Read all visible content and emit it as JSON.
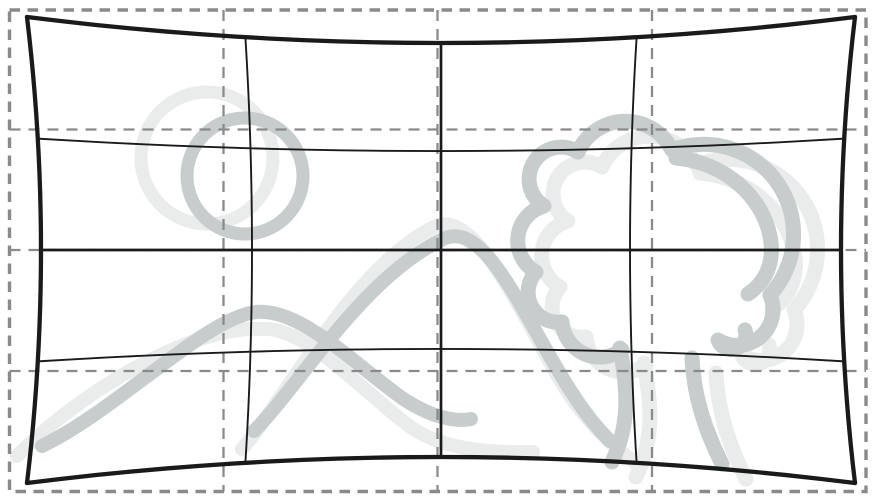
{
  "figure": {
    "width": 877,
    "height": 502,
    "style": "pincushion-distortion",
    "colors": {
      "background": "#ffffff",
      "grid_solid": "#1a1a1a",
      "grid_dashed": "#8a8a8a",
      "sketch_dark": "#c7cccc",
      "sketch_light": "#e9eceb"
    },
    "sketch": {
      "layers": [
        {
          "name": "sun-sketch-light",
          "tone": "sketch_light",
          "stroke_width": 13,
          "shapes": [
            {
              "kind": "circle",
              "cx": 207,
              "cy": 158,
              "r": 66
            }
          ]
        },
        {
          "name": "mountain-sketch-light",
          "tone": "sketch_light",
          "stroke_width": 14,
          "shapes": [
            {
              "kind": "path",
              "d": "M 17,456 C 80,392 192,325 262,329 C 306,326 360,390 412,428 C 444,450 492,453 533,452"
            },
            {
              "kind": "path",
              "d": "M 242,449 C 288,396 352,268 434,227 C 477,206 522,318 566,390 C 590,427 620,452 641,467"
            }
          ]
        },
        {
          "name": "tree-sketch-light",
          "tone": "sketch_light",
          "stroke_width": 15,
          "transform": "translate(24,15)",
          "shapes": [
            {
              "kind": "path",
              "d": "M 622,350 A 38,38 0 0 1 562,322 A 30,30 0 0 1 536,272 A 36,36 0 0 1 544,206 A 30,30 0 0 1 578,152 A 52,52 0 0 1 672,150 A 90,90 0 0 1 770,295 A 36,36 0 0 1 718,340 A 14,14 0 0 0 745,330"
            },
            {
              "kind": "path",
              "d": "M 676,158 C 724,162 762,196 770,236 C 775,262 766,282 748,294"
            },
            {
              "kind": "path",
              "d": "M 620,348 C 628,392 630,424 612,462"
            },
            {
              "kind": "path",
              "d": "M 692,358 C 694,398 706,432 722,464"
            }
          ]
        },
        {
          "name": "sun-sketch-dark",
          "tone": "sketch_dark",
          "stroke_width": 13,
          "shapes": [
            {
              "kind": "circle",
              "cx": 245,
              "cy": 176,
              "r": 58
            }
          ]
        },
        {
          "name": "mountain-sketch-dark",
          "tone": "sketch_dark",
          "stroke_width": 14,
          "shapes": [
            {
              "kind": "path",
              "d": "M 42,446 C 120,408 205,318 256,312 C 300,308 352,362 402,398 C 432,418 456,422 471,419"
            },
            {
              "kind": "path",
              "d": "M 254,431 C 300,385 362,278 443,239 C 487,218 525,322 574,396 C 589,419 601,432 610,441"
            }
          ]
        },
        {
          "name": "tree-sketch-dark",
          "tone": "sketch_dark",
          "stroke_width": 15,
          "shapes": [
            {
              "kind": "path",
              "d": "M 622,350 A 38,38 0 0 1 562,322 A 30,30 0 0 1 536,272 A 36,36 0 0 1 544,206 A 30,30 0 0 1 578,152 A 52,52 0 0 1 672,150 A 90,90 0 0 1 770,295 A 36,36 0 0 1 718,340 A 14,14 0 0 0 745,330"
            },
            {
              "kind": "path",
              "d": "M 676,158 C 724,162 762,196 770,236 C 775,262 766,282 748,294"
            },
            {
              "kind": "path",
              "d": "M 620,348 C 628,392 630,424 612,462"
            },
            {
              "kind": "path",
              "d": "M 692,358 C 694,398 706,432 722,464"
            }
          ]
        }
      ]
    },
    "reference_grid": {
      "left": 9.5,
      "top": 10,
      "right": 866,
      "bottom": 491.5,
      "border_width": 3.4,
      "border_dash": "10.5 7.5",
      "inner_width": 2.3,
      "inner_dash": "11 8",
      "vertical_lines": [
        223.5,
        437.5,
        652
      ],
      "horizontal_lines": [
        129.5,
        250,
        371
      ]
    },
    "distorted_grid": {
      "cx": 441,
      "cy": 250,
      "half_width": 414,
      "half_height": 233,
      "kx": 0.0338,
      "ky": 0.1116,
      "u_lines": [
        {
          "pos": -1,
          "width": 4.3
        },
        {
          "pos": -0.4725,
          "width": 1.9
        },
        {
          "pos": 0,
          "width": 2.7
        },
        {
          "pos": 0.4725,
          "width": 1.9
        },
        {
          "pos": 1,
          "width": 4.3
        }
      ],
      "v_lines": [
        {
          "pos": -1,
          "width": 4.3
        },
        {
          "pos": -0.478,
          "width": 1.9
        },
        {
          "pos": 0,
          "width": 2.7
        },
        {
          "pos": 0.478,
          "width": 1.9
        },
        {
          "pos": 1,
          "width": 4.3
        }
      ],
      "samples": 24
    }
  }
}
